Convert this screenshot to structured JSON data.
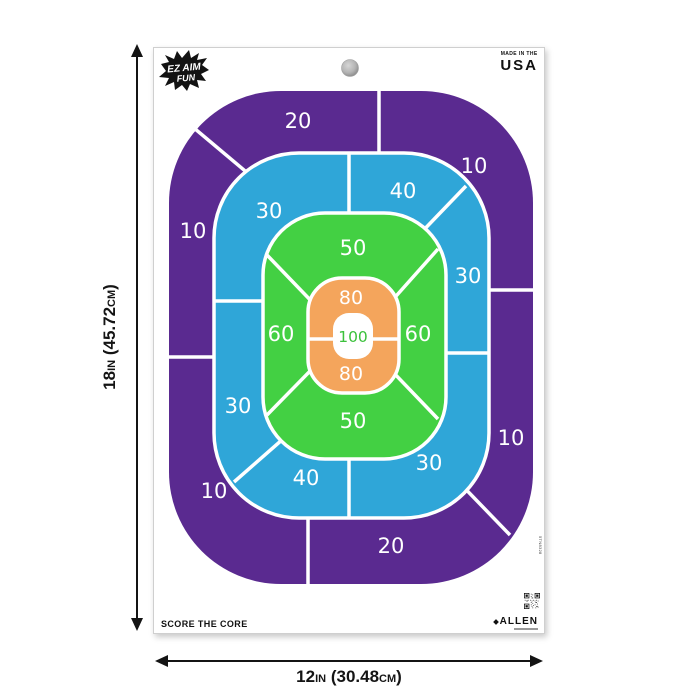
{
  "sheet": {
    "brand": {
      "line1": "EZ AIM",
      "line2": "FUN"
    },
    "origin": {
      "line1": "MADE IN THE",
      "line2": "USA"
    },
    "tagline": "SCORE THE CORE",
    "manufacturer": "ALLEN",
    "item_code": "5TN8328"
  },
  "target": {
    "type": "oval-score-zone-target",
    "labels": {
      "purple_top": "20",
      "purple_top_right": "10",
      "purple_left": "10",
      "purple_right": "10",
      "purple_bottom_left": "10",
      "purple_bottom": "20",
      "blue_top_left": "30",
      "blue_top_right": "40",
      "blue_right": "30",
      "blue_left": "30",
      "blue_bottom": "40",
      "blue_bottom_right": "30",
      "green_top": "50",
      "green_left": "60",
      "green_right": "60",
      "green_bottom": "50",
      "orange_top": "80",
      "orange_bottom": "80",
      "core": "100"
    },
    "colors": {
      "ring_10_20": "#5A2A90",
      "ring_30_40": "#2FA6D8",
      "ring_50_60": "#43D043",
      "ring_80": "#F4A55C",
      "core_bg": "#FFFFFF",
      "core_text": "#3CC13C",
      "divider": "#FFFFFF"
    }
  },
  "dimensions": {
    "height": {
      "value": "18",
      "unit": "IN",
      "metric_value": " (45.72",
      "metric_unit": "CM",
      "close": ")"
    },
    "width": {
      "value": "12",
      "unit": "IN",
      "metric_value": " (30.48",
      "metric_unit": "CM",
      "close": ")"
    }
  }
}
